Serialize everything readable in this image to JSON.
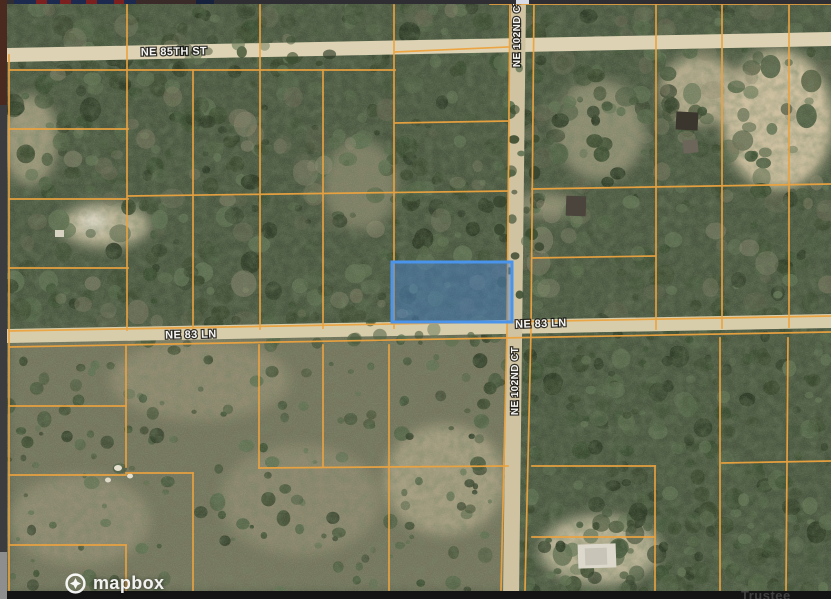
{
  "map": {
    "labels": {
      "ne85th": "NE 85TH ST",
      "ne102nd_top": "NE 102ND CT",
      "ne83_left": "NE 83 LN",
      "ne83_right": "NE 83 LN",
      "ne102nd_bottom": "NE 102ND CT"
    },
    "parcel_line_color": "#ECA33F",
    "highlighted_parcel": {
      "stroke": "#4A94EC",
      "fill": "rgba(70,134,214,0.45)"
    },
    "attribution": {
      "logo_text": "mapbox"
    }
  },
  "footer": {
    "partial_text": "Trustee"
  }
}
